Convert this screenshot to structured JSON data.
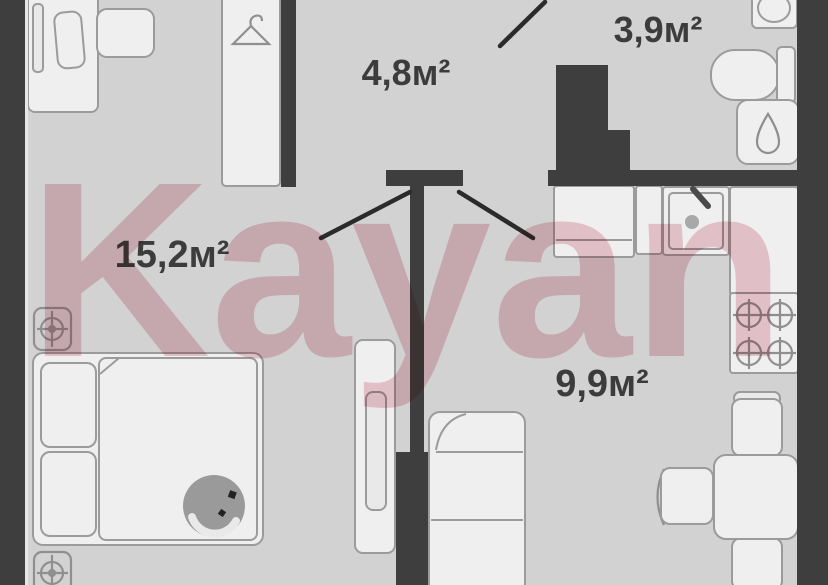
{
  "watermark": {
    "text": "Kayan",
    "color": "#eec5ce"
  },
  "rooms": {
    "hallway": {
      "name": "hallway",
      "area_label": "4,8м²"
    },
    "bathroom": {
      "name": "bathroom",
      "area_label": "3,9м²"
    },
    "bedroom": {
      "name": "bedroom",
      "area_label": "15,2м²"
    },
    "living_kitchen": {
      "name": "living-kitchen",
      "area_label": "9,9м²"
    }
  },
  "icons": [
    "hanger-icon",
    "droplet-icon",
    "vent-crosshair-icon",
    "burner-icon",
    "faucet-icon"
  ],
  "colors": {
    "wall": "#3e3e3e",
    "floor": "#d2d2d2",
    "furniture_fill": "#efefef",
    "furniture_stroke": "#9b9b9b",
    "label_text": "#3c3c3c",
    "watermark_pink": "#eec5ce"
  }
}
